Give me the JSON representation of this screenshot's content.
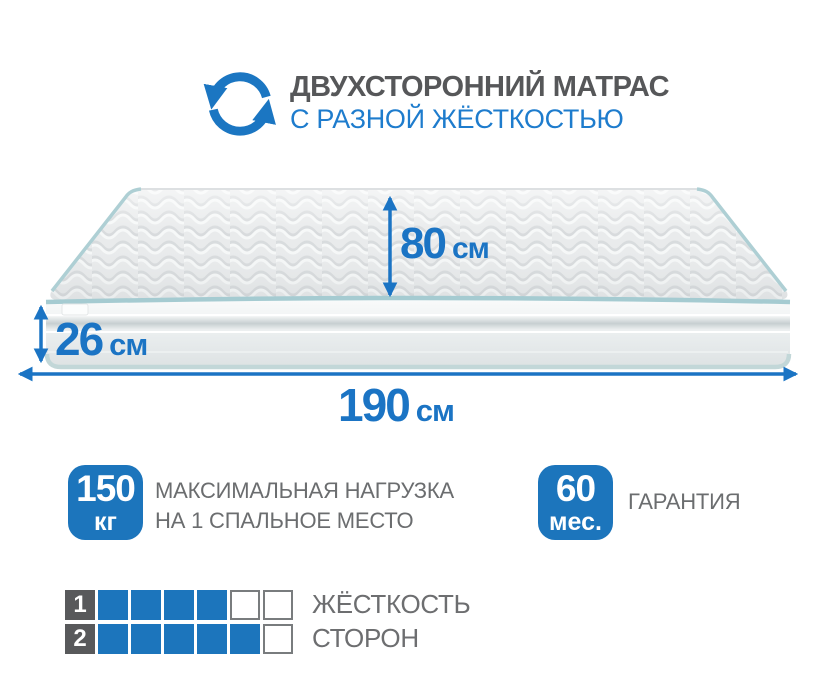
{
  "header": {
    "title": "ДВУХСТОРОННИЙ МАТРАС",
    "subtitle": "С РАЗНОЙ ЖЁСТКОСТЬЮ"
  },
  "dimensions": {
    "depth": {
      "value": "80",
      "unit": "см"
    },
    "height": {
      "value": "26",
      "unit": "см"
    },
    "length": {
      "value": "190",
      "unit": "см"
    }
  },
  "features": {
    "max_load": {
      "badge_value": "150",
      "badge_unit": "кг",
      "line1": "МАКСИМАЛЬНАЯ НАГРУЗКА",
      "line2": "НА 1 СПАЛЬНОЕ МЕСТО"
    },
    "warranty": {
      "badge_value": "60",
      "badge_unit": "мес.",
      "label": "ГАРАНТИЯ"
    }
  },
  "firmness": {
    "scale_max": 6,
    "rows": [
      {
        "side": "1",
        "filled": 4
      },
      {
        "side": "2",
        "filled": 5
      }
    ],
    "label_line1": "ЖЁСТКОСТЬ",
    "label_line2": "СТОРОН"
  },
  "colors": {
    "accent_blue": "#1b74c4",
    "badge_blue": "#1c75bc",
    "subtitle_blue": "#1e7ccd",
    "title_gray": "#565759",
    "text_gray": "#6b6d6f",
    "number_square_gray": "#58595b",
    "piping_teal": "#a5cbd1"
  },
  "icons": {
    "rotate": "rotate-arrows-icon"
  }
}
